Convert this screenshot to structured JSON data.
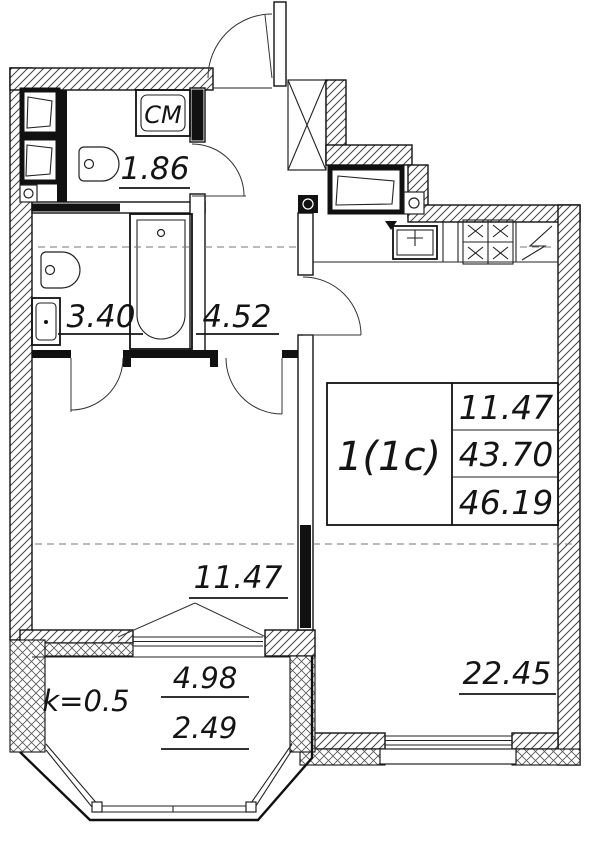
{
  "unit": {
    "type_label": "1(1c)",
    "living_area": "11.47",
    "apartment_area": "43.70",
    "total_area": "46.19"
  },
  "rooms": {
    "laundry": {
      "area": "1.86",
      "appliance_label": "СМ"
    },
    "bathroom": {
      "area": "3.40"
    },
    "hallway": {
      "area": "4.52"
    },
    "bedroom": {
      "area": "11.47"
    },
    "living_kitchen": {
      "area": "22.45"
    }
  },
  "balcony": {
    "coefficient": "k=0.5",
    "area_full": "4.98",
    "area_reduced": "2.49"
  },
  "colors": {
    "line": "#111111",
    "background": "#ffffff"
  }
}
